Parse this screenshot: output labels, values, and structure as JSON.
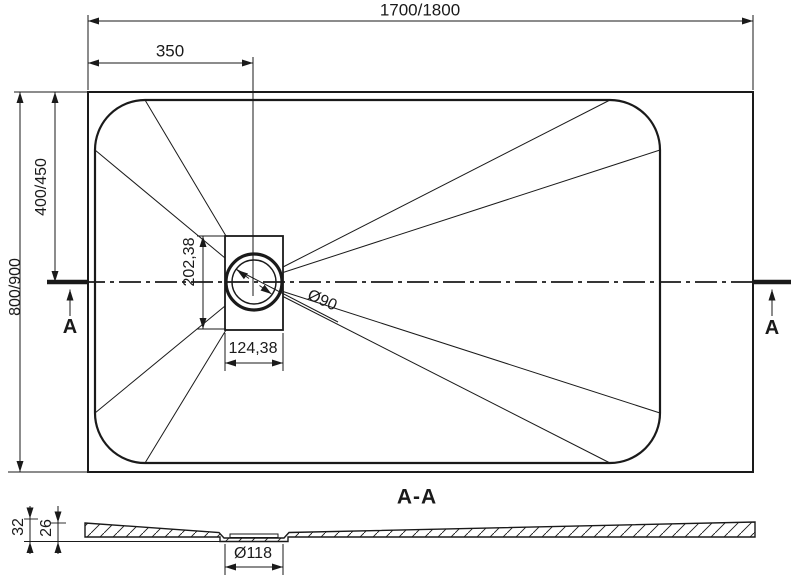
{
  "plan": {
    "length_label": "1700/1800",
    "drain_offset_label": "350",
    "width_label": "800/900",
    "drain_center_label": "400/450",
    "drain_box_height_label": "202,38",
    "drain_box_width_label": "124,38",
    "drain_diameter_label": "Ø90",
    "section_cut_label": "A"
  },
  "section": {
    "title": "A-A",
    "edge_height_label": "32",
    "surface_height_label": "26",
    "drain_recess_label": "Ø118"
  },
  "colors": {
    "line": "#1a1a1a",
    "background": "#ffffff"
  }
}
